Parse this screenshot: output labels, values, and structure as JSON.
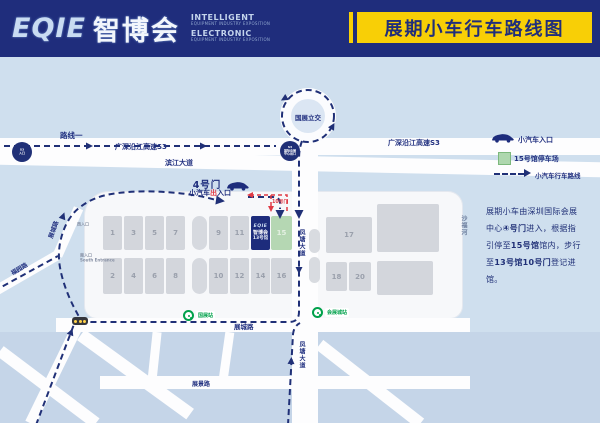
{
  "header": {
    "logo_main": "EQIE",
    "logo_cn": "智博会",
    "tagline_top": "INTELLIGENT",
    "tagline_top_sub": "EQUIPMENT INDUSTRY EXPOSITION",
    "tagline_bottom": "ELECTRONIC",
    "tagline_bottom_sub": "EQUIPMENT INDUSTRY EXPOSITION",
    "title_banner": "展期小车行车路线图"
  },
  "map": {
    "route_label": "路线一",
    "highway_left": "广深沿江高速S3",
    "highway_right": "广深沿江高速S3",
    "interchange": "国展立交",
    "exit_badge": {
      "l1": "S3",
      "l2": "国际会展",
      "l3": "中心出口"
    },
    "entry_badge": {
      "l1": "S3",
      "l2": "入口"
    },
    "roads": {
      "binjiang": "滨江大道",
      "fengtang_north": "凤塘大道",
      "fengtang_south": "凤塘大道",
      "zhancheng_west": "展城路",
      "zhancheng_south": "展城路",
      "fuyuan": "福园路",
      "zhanjing": "展景路",
      "river": "沙福河"
    },
    "gate4": {
      "title": "4号门",
      "sub_pre": "小汽车",
      "sub_red": "出",
      "sub_post": "入口"
    },
    "gate10": "10号门",
    "entrances": {
      "west": "西入口",
      "south": "南入口",
      "south_en": "South Entrance"
    },
    "stations": {
      "center": "国展站",
      "east": "会展城站"
    },
    "halls": {
      "top": [
        "1",
        "3",
        "5",
        "7",
        "9",
        "11"
      ],
      "bottom": [
        "2",
        "4",
        "6",
        "8",
        "10",
        "12",
        "14",
        "16"
      ],
      "east": [
        "17",
        "18",
        "20"
      ],
      "hall13": {
        "logo": "EQIE",
        "cn": "智博会",
        "label": "13号馆"
      },
      "hall15": "15"
    }
  },
  "legend": {
    "car": "小汽车入口",
    "parking": "15号馆停车场",
    "route": "小汽车行车路线"
  },
  "note": {
    "line1": "展期小车由深圳国际会展",
    "line2_pre": "中心",
    "line2_bold": "④号门",
    "line2_post": "进入，根据指",
    "line3_pre": "引停至",
    "line3_bold": "15号馆",
    "line3_post": "馆内，步行",
    "line4_pre": "至",
    "line4_bold": "13号馆10号门",
    "line4_post": "登记进",
    "line5": "馆。"
  },
  "colors": {
    "navy": "#1f2d7c",
    "yellow": "#f8cf06",
    "red": "#e03a45",
    "hall13_blue": "#1d2c7c",
    "hall15_green": "#b5d7b3",
    "map_bg": "#cfdfee",
    "metro_green": "#00a14b"
  }
}
